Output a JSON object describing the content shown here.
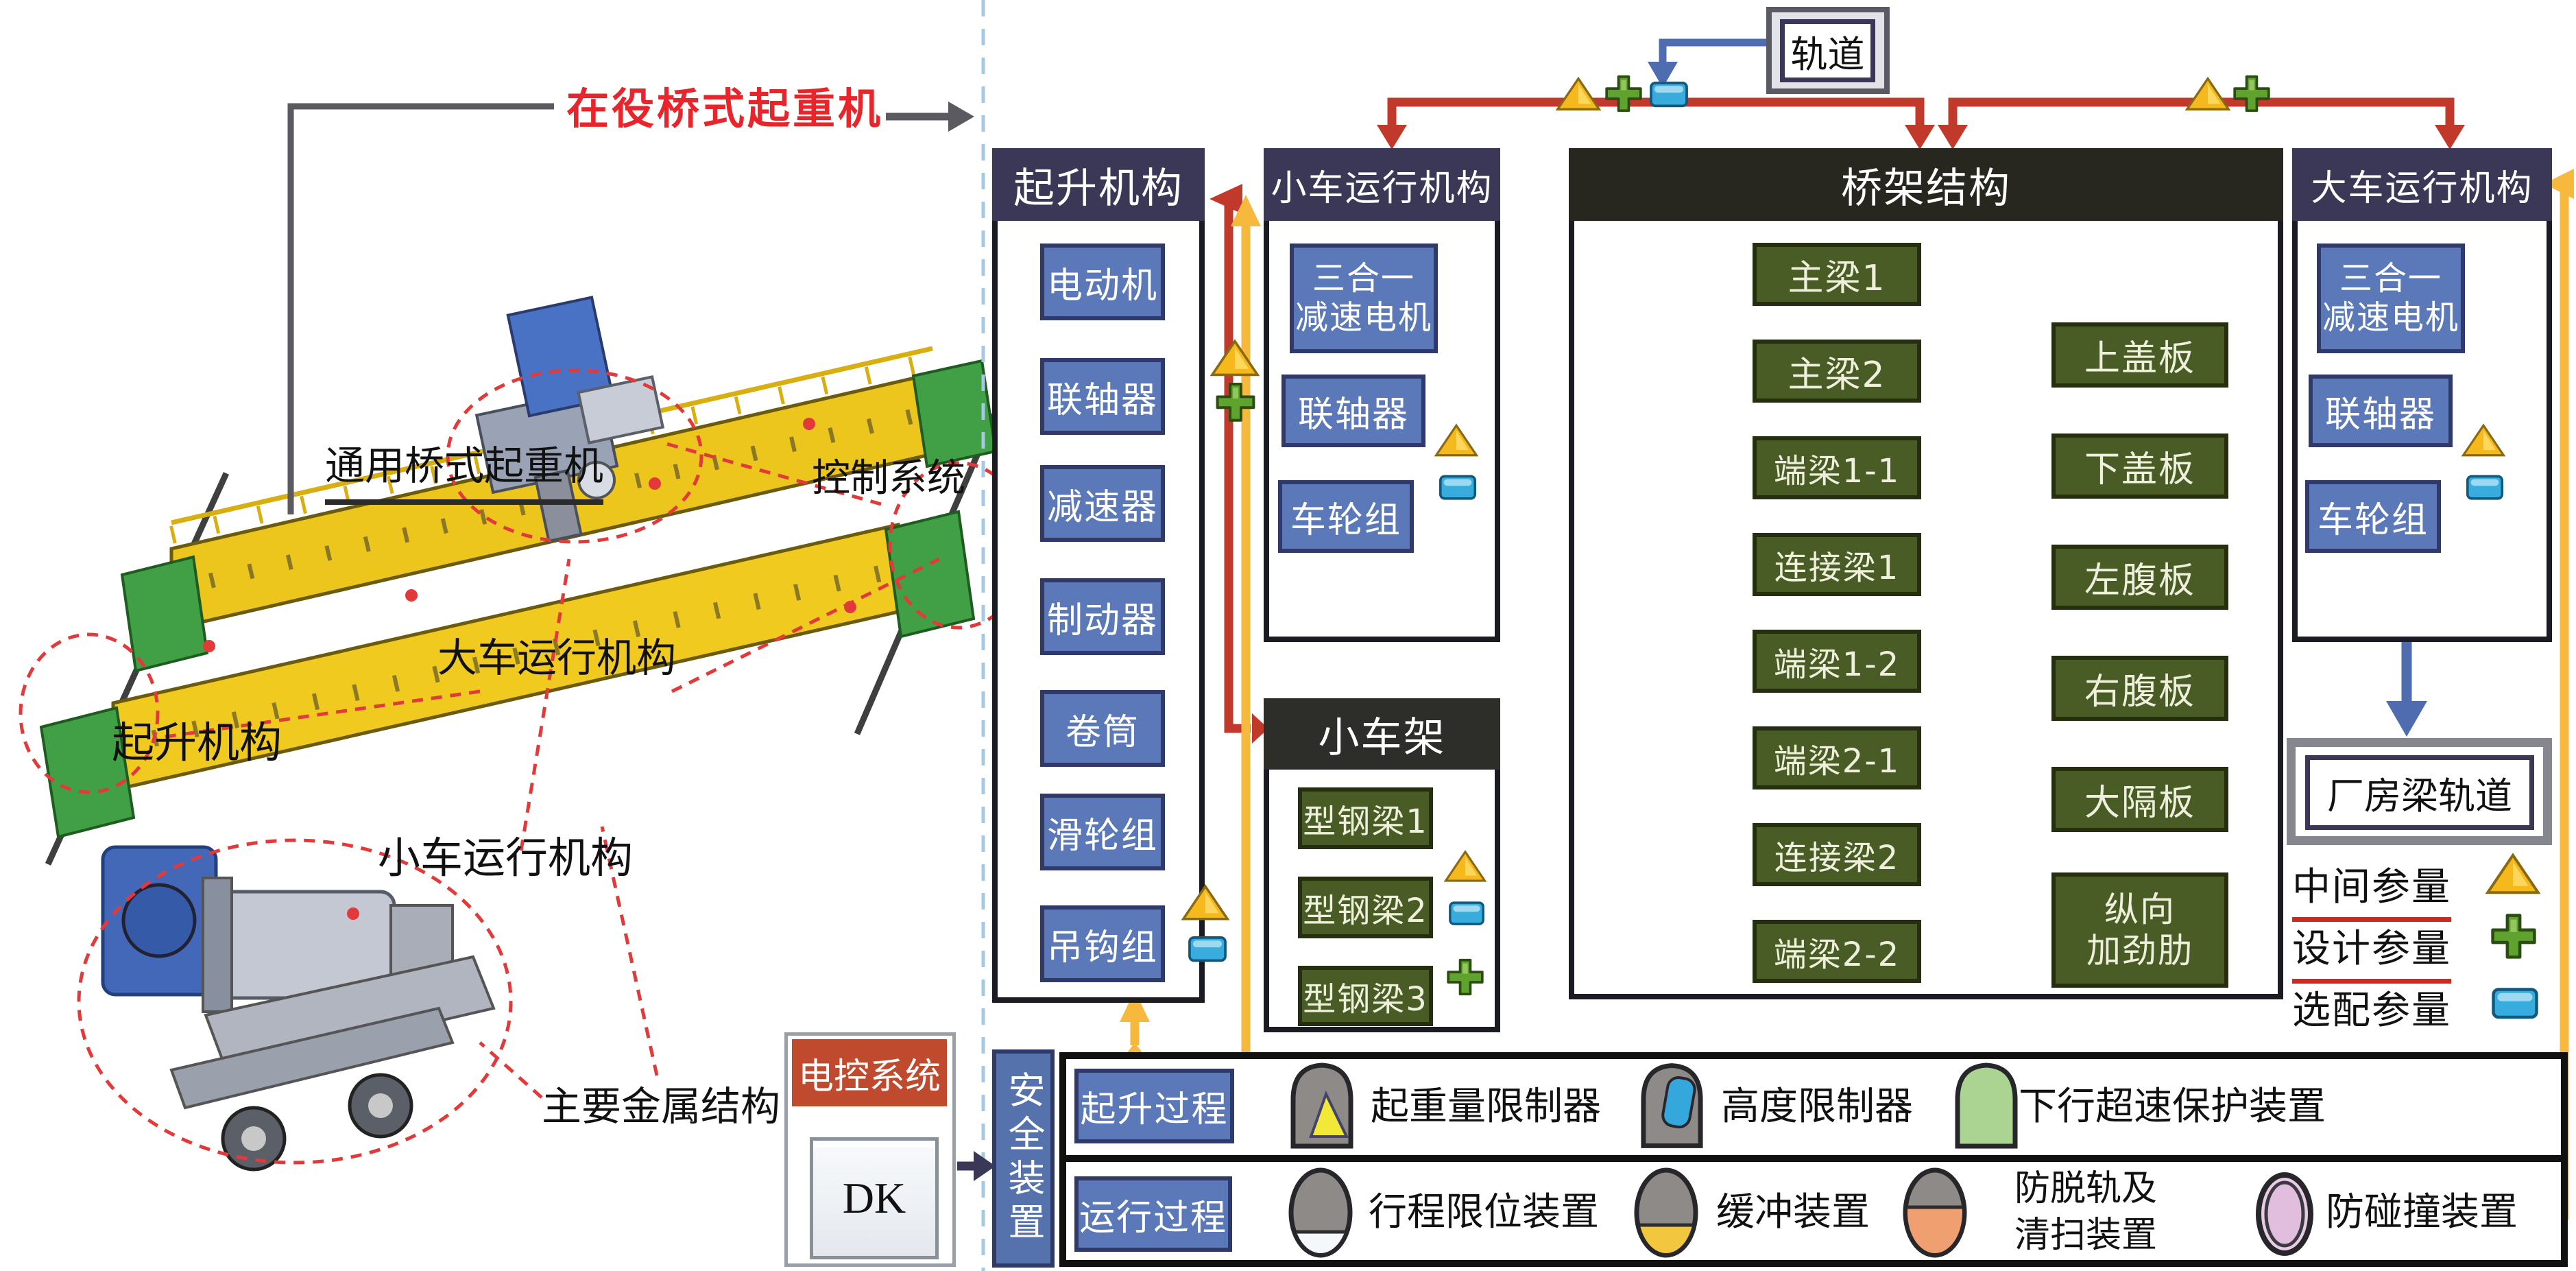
{
  "title": {
    "in_service": "在役桥式起重机",
    "general": "通用桥式起重机"
  },
  "illustration_labels": {
    "cart_mechanism": "大车运行机构",
    "control_system": "控制系统",
    "hoist_mechanism": "起升机构",
    "trolley_mechanism": "小车运行机构",
    "main_metal_structure": "主要金属结构"
  },
  "track_box": {
    "label": "轨道"
  },
  "hoist_panel": {
    "title": "起升机构",
    "items": [
      "电动机",
      "联轴器",
      "减速器",
      "制动器",
      "卷筒",
      "滑轮组",
      "吊钩组"
    ]
  },
  "trolley_run_panel": {
    "title": "小车运行机构",
    "motor_line1": "三合一",
    "motor_line2": "减速电机",
    "coupling": "联轴器",
    "wheel_set": "车轮组"
  },
  "trolley_frame_panel": {
    "title": "小车架",
    "items": [
      "型钢梁1",
      "型钢梁2",
      "型钢梁3"
    ]
  },
  "bridge_panel": {
    "title": "桥架结构",
    "left_items": [
      "主梁1",
      "主梁2",
      "端梁1-1",
      "连接梁1",
      "端梁1-2",
      "端梁2-1",
      "连接梁2",
      "端梁2-2"
    ],
    "right_items": [
      "上盖板",
      "下盖板",
      "左腹板",
      "右腹板",
      "大隔板"
    ],
    "stiffener_line1": "纵向",
    "stiffener_line2": "加劲肋"
  },
  "cart_run_panel": {
    "title": "大车运行机构",
    "motor_line1": "三合一",
    "motor_line2": "减速电机",
    "coupling": "联轴器",
    "wheel_set": "车轮组",
    "factory_track": "厂房梁轨道"
  },
  "legend": {
    "intermediate": "中间参量",
    "design": "设计参量",
    "optional": "选配参量"
  },
  "electric_control": {
    "title": "电控系统",
    "dk": "DK"
  },
  "safety": {
    "title": "安全装置",
    "hoist_stage": "起升过程",
    "run_stage": "运行过程",
    "load_limiter": "起重量限制器",
    "height_limiter": "高度限制器",
    "overspeed": "下行超速保护装置",
    "travel_limit": "行程限位装置",
    "buffer": "缓冲装置",
    "derail_line1": "防脱轨及",
    "derail_line2": "清扫装置",
    "anti_collision": "防碰撞装置"
  },
  "colors": {
    "red_connector": "#c0392b",
    "yellow_connector": "#f6b83d",
    "blue_connector": "#4f6cb0",
    "panel_header": "#3b3757",
    "blue_box": "#5b79b8",
    "green_box": "#4a5c26",
    "dark_header": "#27271f",
    "electric_red": "#bf4a2e",
    "title_red": "#e8252a"
  },
  "icons": {
    "intermediate": "gold-triangle",
    "design": "green-plus",
    "optional": "blue-square"
  }
}
